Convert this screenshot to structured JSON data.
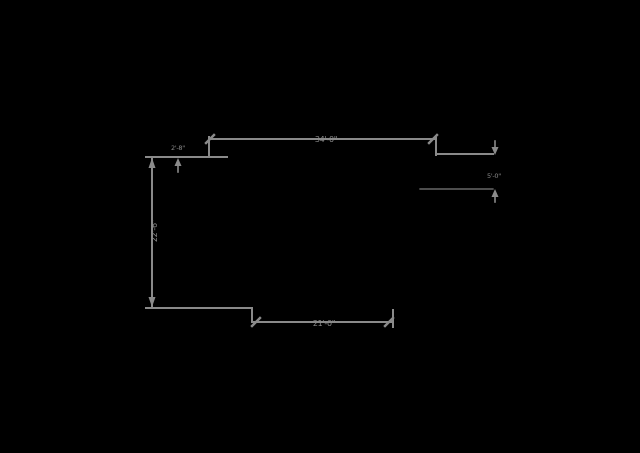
{
  "canvas": {
    "background": "#000000",
    "line_color": "#8a8a8a"
  },
  "dimensions": {
    "top": {
      "label": "34'-0\""
    },
    "bottom": {
      "label": "21'-0\""
    },
    "left": {
      "label": "22'-6\""
    },
    "left_small": {
      "label": "2'-8\""
    },
    "right_small": {
      "label": "5'-0\""
    }
  }
}
